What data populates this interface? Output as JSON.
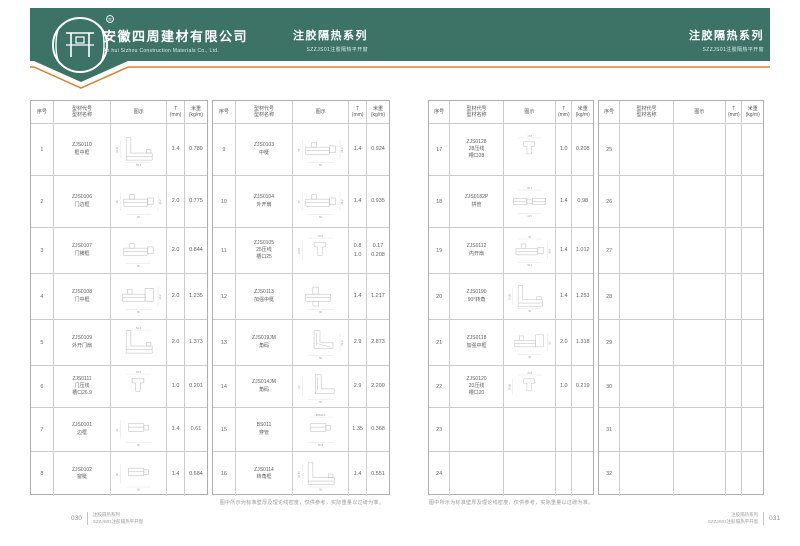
{
  "header": {
    "logo_mark": "四周",
    "registered": "R",
    "company_cn": "安徽四周建材有限公司",
    "company_en": "An hui Sizhou Construction Materials Co., Ltd.",
    "series_title": "注胶隔热系列",
    "series_subtitle": "SZZJS01注胶隔热平开窗"
  },
  "colors": {
    "band_green": "#3d7267",
    "accent_orange": "#d9822f",
    "table_border": "#b0b0b0",
    "diagram_line": "#b6b6bb"
  },
  "table_header": {
    "no": "序号",
    "model_line1": "型材代号",
    "model_line2": "型材名称",
    "diagram": "图示",
    "t_line1": "T",
    "t_line2": "(mm)",
    "w_line1": "米重",
    "w_line2": "(kg/m)"
  },
  "note": "图中所示为标准壁厚及理论线密度，仅供参考，实际重量以过磅为准。",
  "pages": {
    "left": {
      "page_no": "030",
      "footer_line1": "注胶隔热系列",
      "footer_line2": "SZZJS01注胶隔热平开窗",
      "tables": [
        {
          "rows": [
            {
              "no": "1",
              "code": "ZJS0110",
              "name": "框中框",
              "t": "1.4",
              "w": "0.789",
              "diagram": {
                "kind": "lframe",
                "dims": [
                  {
                    "side": "left",
                    "label": "50.8"
                  },
                  {
                    "side": "bottom",
                    "label": "56.4"
                  }
                ]
              }
            },
            {
              "no": "2",
              "code": "ZJS0106",
              "name": "门边框",
              "t": "2.0",
              "w": "0.775",
              "diagram": {
                "kind": "hprofile",
                "dims": [
                  {
                    "side": "left",
                    "label": "26"
                  },
                  {
                    "side": "bottom",
                    "label": "50"
                  },
                  {
                    "side": "right",
                    "label": "40.2"
                  }
                ]
              }
            },
            {
              "no": "3",
              "code": "ZJS0107",
              "name": "门横框",
              "t": "2.0",
              "w": "0.844",
              "diagram": {
                "kind": "hprofile",
                "dims": [
                  {
                    "side": "bottom",
                    "label": "50"
                  }
                ]
              }
            },
            {
              "no": "4",
              "code": "ZJS0108",
              "name": "门中框",
              "t": "2.0",
              "w": "1.235",
              "diagram": {
                "kind": "hprofile2",
                "dims": [
                  {
                    "side": "bottom",
                    "label": "50"
                  },
                  {
                    "side": "right",
                    "label": "40.2"
                  }
                ]
              }
            },
            {
              "no": "5",
              "code": "ZJS0109",
              "name": "外开门扇",
              "t": "2.0",
              "w": "1.373",
              "diagram": {
                "kind": "lframe",
                "dims": [
                  {
                    "side": "top",
                    "label": "62.4"
                  }
                ]
              }
            },
            {
              "no": "6",
              "code": "ZJS0111",
              "name": "门压线",
              "name2": "槽口26.9",
              "t": "1.0",
              "w": "0.201",
              "diagram": {
                "kind": "uchannel",
                "dims": [
                  {
                    "side": "top",
                    "label": "20.6"
                  }
                ]
              }
            },
            {
              "no": "7",
              "code": "ZJS0101",
              "name": "边框",
              "t": "1.4",
              "w": "0.61",
              "diagram": {
                "kind": "tube",
                "dims": [
                  {
                    "side": "left",
                    "label": "43"
                  },
                  {
                    "side": "bottom",
                    "label": "50"
                  }
                ]
              }
            },
            {
              "no": "8",
              "code": "ZJS0102",
              "name": "窗梃",
              "t": "1.4",
              "w": "0.684",
              "diagram": {
                "kind": "tube",
                "dims": [
                  {
                    "side": "left",
                    "label": "40"
                  },
                  {
                    "side": "bottom",
                    "label": "50"
                  }
                ]
              }
            }
          ]
        },
        {
          "rows": [
            {
              "no": "9",
              "code": "ZJS0103",
              "name": "中梃",
              "t": "1.4",
              "w": "0.924",
              "diagram": {
                "kind": "hprofile",
                "dims": [
                  {
                    "side": "left",
                    "label": "56"
                  },
                  {
                    "side": "bottom",
                    "label": "56"
                  },
                  {
                    "side": "right",
                    "label": "26.2"
                  }
                ]
              }
            },
            {
              "no": "10",
              "code": "ZJS0104",
              "name": "外开扇",
              "t": "1.4",
              "w": "0.935",
              "diagram": {
                "kind": "hprofile",
                "dims": [
                  {
                    "side": "left",
                    "label": "55"
                  },
                  {
                    "side": "bottom",
                    "label": "56"
                  },
                  {
                    "side": "right",
                    "label": "26.2"
                  }
                ]
              }
            },
            {
              "no": "11",
              "code": "ZJS0105",
              "name": "25压线",
              "name2": "槽口25",
              "t": "0.8\n1.0",
              "w": "0.17\n0.208",
              "diagram": {
                "kind": "uchannel",
                "dims": [
                  {
                    "side": "top",
                    "label": "20.6"
                  },
                  {
                    "side": "left",
                    "label": "23.05"
                  }
                ]
              }
            },
            {
              "no": "12",
              "code": "ZJS0113",
              "name": "加强中梃",
              "t": "1.4",
              "w": "1.217",
              "diagram": {
                "kind": "cross",
                "dims": [
                  {
                    "side": "bottom",
                    "label": "50"
                  }
                ]
              }
            },
            {
              "no": "13",
              "code": "ZJS019JM",
              "name": "角码",
              "t": "2.9",
              "w": "2.873",
              "diagram": {
                "kind": "corner",
                "dims": [
                  {
                    "side": "bottom",
                    "label": "60"
                  },
                  {
                    "side": "right",
                    "label": "52.4"
                  }
                ]
              }
            },
            {
              "no": "14",
              "code": "ZJS014JM",
              "name": "角码",
              "t": "2.9",
              "w": "2.209",
              "diagram": {
                "kind": "corner2",
                "dims": [
                  {
                    "side": "left",
                    "label": "60"
                  },
                  {
                    "side": "bottom",
                    "label": "60"
                  }
                ]
              }
            },
            {
              "no": "15",
              "code": "BS011",
              "name": "穿管",
              "t": "1.35",
              "w": "0.368",
              "diagram": {
                "kind": "tube",
                "dims": [
                  {
                    "side": "top",
                    "label": "BS011A"
                  },
                  {
                    "side": "bottom",
                    "label": "50.6"
                  }
                ]
              }
            },
            {
              "no": "16",
              "code": "ZJS0114",
              "name": "转角框",
              "t": "1.4",
              "w": "0.551",
              "diagram": {
                "kind": "lframe",
                "dims": [
                  {
                    "side": "left",
                    "label": "44.85"
                  },
                  {
                    "side": "bottom",
                    "label": "50"
                  }
                ]
              }
            }
          ]
        }
      ]
    },
    "right": {
      "page_no": "031",
      "footer_line1": "注胶隔热系列",
      "footer_line2": "SZZJS01注胶隔热平开窗",
      "tables": [
        {
          "rows": [
            {
              "no": "17",
              "code": "ZJS0128",
              "name": "28压线",
              "name2": "槽口28",
              "t": "1.0",
              "w": "0.208",
              "diagram": {
                "kind": "uchannel",
                "dims": [
                  {
                    "side": "top",
                    "label": "17.8"
                  }
                ]
              }
            },
            {
              "no": "18",
              "code": "ZJS0182P",
              "name": "拼管",
              "t": "1.4",
              "w": "0.98",
              "diagram": {
                "kind": "wide",
                "dims": [
                  {
                    "side": "top",
                    "label": "82.4"
                  },
                  {
                    "side": "bottom",
                    "label": "41.5"
                  }
                ]
              }
            },
            {
              "no": "19",
              "code": "ZJS0112",
              "name": "内开扇",
              "t": "1.4",
              "w": "1.012",
              "diagram": {
                "kind": "hprofile",
                "dims": [
                  {
                    "side": "top",
                    "label": "50"
                  },
                  {
                    "side": "bottom",
                    "label": "66.1"
                  },
                  {
                    "side": "right",
                    "label": "65.5"
                  }
                ]
              }
            },
            {
              "no": "20",
              "code": "ZJS0190",
              "name": "90°转角",
              "t": "1.4",
              "w": "1.253",
              "diagram": {
                "kind": "lframe",
                "dims": [
                  {
                    "side": "left",
                    "label": "73.98"
                  },
                  {
                    "side": "bottom",
                    "label": "50"
                  }
                ]
              }
            },
            {
              "no": "21",
              "code": "ZJS0118",
              "name": "加强中框",
              "t": "2.0",
              "w": "1.318",
              "diagram": {
                "kind": "hprofile2",
                "dims": [
                  {
                    "side": "bottom",
                    "label": "50"
                  },
                  {
                    "side": "right",
                    "label": "50"
                  }
                ]
              }
            },
            {
              "no": "22",
              "code": "ZJS0120",
              "name": "20压线",
              "name2": "槽口20",
              "t": "1.0",
              "w": "0.219",
              "diagram": {
                "kind": "uchannel",
                "dims": [
                  {
                    "side": "top",
                    "label": "20.8"
                  },
                  {
                    "side": "left",
                    "label": "25.86"
                  }
                ]
              }
            },
            {
              "no": "23"
            },
            {
              "no": "24"
            }
          ]
        },
        {
          "rows": [
            {
              "no": "25"
            },
            {
              "no": "26"
            },
            {
              "no": "27"
            },
            {
              "no": "28"
            },
            {
              "no": "29"
            },
            {
              "no": "30"
            },
            {
              "no": "31"
            },
            {
              "no": "32"
            }
          ]
        }
      ]
    }
  }
}
